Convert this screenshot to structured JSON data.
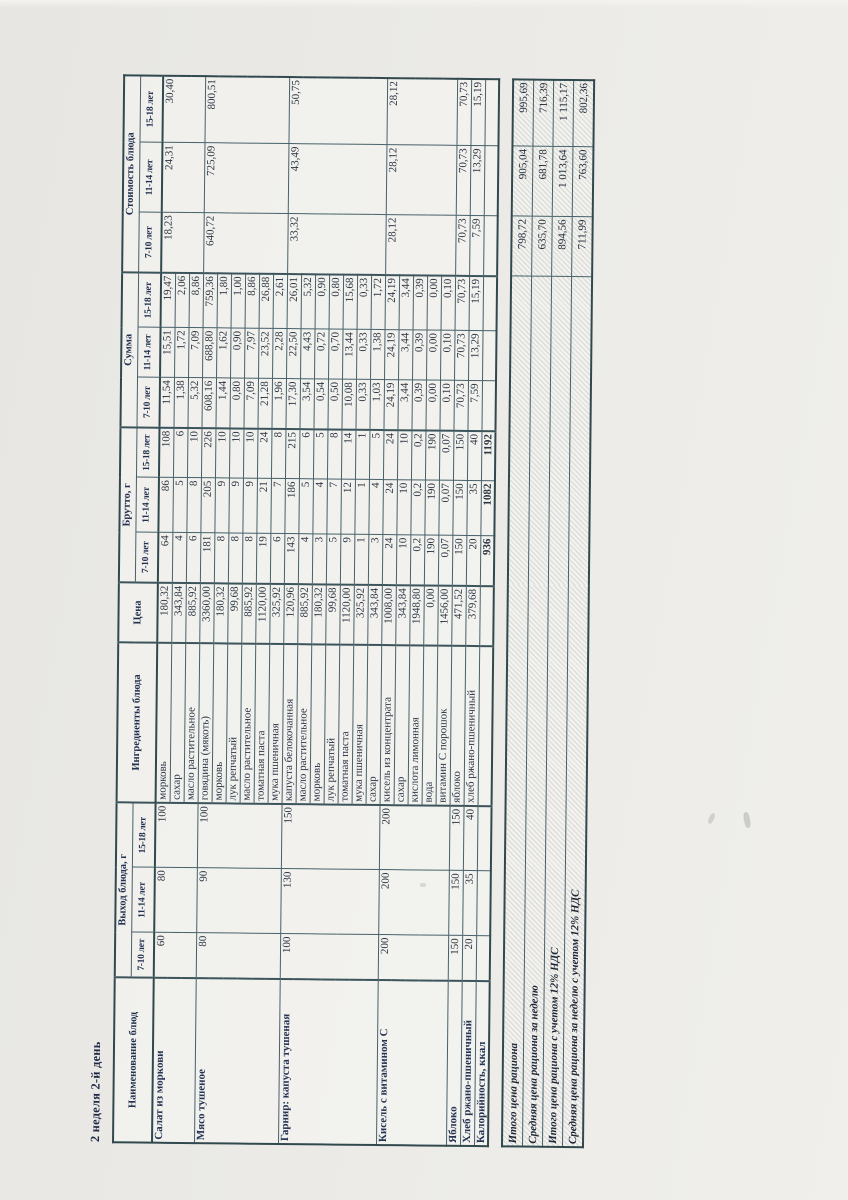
{
  "page": {
    "title": "2 неделя 2-й день"
  },
  "colors": {
    "paper": "#ebeae6",
    "ink": "#2b3442",
    "header_ink": "#21304f",
    "border": "#47616a"
  },
  "table": {
    "headers": {
      "dish": "Наименование блюд",
      "yield_group": "Выход блюда, г",
      "ingredients": "Ингредиенты блюда",
      "price": "Цена",
      "gross_group": "Брутто, г",
      "sum_group": "Сумма",
      "cost_group": "Стоимость блюда",
      "age_cols": [
        "7-10 лет",
        "11-14 лет",
        "15-18 лет"
      ]
    },
    "dishes": [
      {
        "name": "Салат из моркови",
        "yield": [
          "60",
          "80",
          "100"
        ],
        "cost": [
          "18,23",
          "24,31",
          "30,40"
        ],
        "rows": [
          {
            "ingredient": "морковь",
            "price": "180,32",
            "gross": [
              "64",
              "86",
              "108"
            ],
            "sum": [
              "11,54",
              "15,51",
              "19,47"
            ]
          },
          {
            "ingredient": "сахар",
            "price": "343,84",
            "gross": [
              "4",
              "5",
              "6"
            ],
            "sum": [
              "1,38",
              "1,72",
              "2,06"
            ]
          },
          {
            "ingredient": "масло растительное",
            "price": "885,92",
            "gross": [
              "6",
              "8",
              "10"
            ],
            "sum": [
              "5,32",
              "7,09",
              "8,86"
            ]
          }
        ]
      },
      {
        "name": "Мясо тушеное",
        "yield": [
          "80",
          "90",
          "100"
        ],
        "cost": [
          "640,72",
          "725,09",
          "800,51"
        ],
        "rows": [
          {
            "ingredient": "говядина (мякоть)",
            "price": "3360,00",
            "gross": [
              "181",
              "205",
              "226"
            ],
            "sum": [
              "608,16",
              "688,80",
              "759,36"
            ]
          },
          {
            "ingredient": "морковь",
            "price": "180,32",
            "gross": [
              "8",
              "9",
              "10"
            ],
            "sum": [
              "1,44",
              "1,62",
              "1,80"
            ]
          },
          {
            "ingredient": "лук репчатый",
            "price": "99,68",
            "gross": [
              "8",
              "9",
              "10"
            ],
            "sum": [
              "0,80",
              "0,90",
              "1,00"
            ]
          },
          {
            "ingredient": "масло растительное",
            "price": "885,92",
            "gross": [
              "8",
              "9",
              "10"
            ],
            "sum": [
              "7,09",
              "7,97",
              "8,86"
            ]
          },
          {
            "ingredient": "томатная паста",
            "price": "1120,00",
            "gross": [
              "19",
              "21",
              "24"
            ],
            "sum": [
              "21,28",
              "23,52",
              "26,88"
            ]
          },
          {
            "ingredient": "мука пшеничная",
            "price": "325,92",
            "gross": [
              "6",
              "7",
              "8"
            ],
            "sum": [
              "1,96",
              "2,28",
              "2,61"
            ]
          }
        ]
      },
      {
        "name": "Гарнир: капуста тушеная",
        "yield": [
          "100",
          "130",
          "150"
        ],
        "cost": [
          "33,32",
          "43,49",
          "50,75"
        ],
        "rows": [
          {
            "ingredient": "капуста белокочанная",
            "price": "120,96",
            "gross": [
              "143",
              "186",
              "215"
            ],
            "sum": [
              "17,30",
              "22,50",
              "26,01"
            ]
          },
          {
            "ingredient": "масло растительное",
            "price": "885,92",
            "gross": [
              "4",
              "5",
              "6"
            ],
            "sum": [
              "3,54",
              "4,43",
              "5,32"
            ]
          },
          {
            "ingredient": "морковь",
            "price": "180,32",
            "gross": [
              "3",
              "4",
              "5"
            ],
            "sum": [
              "0,54",
              "0,72",
              "0,90"
            ]
          },
          {
            "ingredient": "лук репчатый",
            "price": "99,68",
            "gross": [
              "5",
              "7",
              "8"
            ],
            "sum": [
              "0,50",
              "0,70",
              "0,80"
            ]
          },
          {
            "ingredient": "томатная паста",
            "price": "1120,00",
            "gross": [
              "9",
              "12",
              "14"
            ],
            "sum": [
              "10,08",
              "13,44",
              "15,68"
            ]
          },
          {
            "ingredient": "мука пшеничная",
            "price": "325,92",
            "gross": [
              "1",
              "1",
              "1"
            ],
            "sum": [
              "0,33",
              "0,33",
              "0,33"
            ]
          },
          {
            "ingredient": "сахар",
            "price": "343,84",
            "gross": [
              "3",
              "4",
              "5"
            ],
            "sum": [
              "1,03",
              "1,38",
              "1,72"
            ]
          }
        ]
      },
      {
        "name": "Кисель с витамином С",
        "yield": [
          "200",
          "200",
          "200"
        ],
        "cost": [
          "28,12",
          "28,12",
          "28,12"
        ],
        "rows": [
          {
            "ingredient": "кисель из концентрата",
            "price": "1008,00",
            "gross": [
              "24",
              "24",
              "24"
            ],
            "sum": [
              "24,19",
              "24,19",
              "24,19"
            ]
          },
          {
            "ingredient": "сахар",
            "price": "343,84",
            "gross": [
              "10",
              "10",
              "10"
            ],
            "sum": [
              "3,44",
              "3,44",
              "3,44"
            ]
          },
          {
            "ingredient": "кислота лимонная",
            "price": "1948,80",
            "gross": [
              "0,2",
              "0,2",
              "0,2"
            ],
            "sum": [
              "0,39",
              "0,39",
              "0,39"
            ]
          },
          {
            "ingredient": "вода",
            "price": "0,00",
            "gross": [
              "190",
              "190",
              "190"
            ],
            "sum": [
              "0,00",
              "0,00",
              "0,00"
            ]
          },
          {
            "ingredient": "витамин С порошок",
            "price": "1456,00",
            "gross": [
              "0,07",
              "0,07",
              "0,07"
            ],
            "sum": [
              "0,10",
              "0,10",
              "0,10"
            ]
          }
        ]
      },
      {
        "name": "Яблоко",
        "yield": [
          "150",
          "150",
          "150"
        ],
        "cost": [
          "70,73",
          "70,73",
          "70,73"
        ],
        "rows": [
          {
            "ingredient": "яблоко",
            "price": "471,52",
            "gross": [
              "150",
              "150",
              "150"
            ],
            "sum": [
              "70,73",
              "70,73",
              "70,73"
            ]
          }
        ]
      },
      {
        "name": "Хлеб ржано-пшеничный",
        "yield": [
          "20",
          "35",
          "40"
        ],
        "cost": [
          "7,59",
          "13,29",
          "15,19"
        ],
        "rows": [
          {
            "ingredient": "хлеб ржано-пшеничный",
            "price": "379,68",
            "gross": [
              "20",
              "35",
              "40"
            ],
            "sum": [
              "7,59",
              "13,29",
              "15,19"
            ]
          }
        ]
      }
    ],
    "calories_row": {
      "label": "Калорийность, ккал",
      "values": [
        "936",
        "1082",
        "1192"
      ]
    }
  },
  "summary": {
    "rows": [
      {
        "label": "Итого цена рациона",
        "values": [
          "798,72",
          "905,04",
          "995,69"
        ]
      },
      {
        "label": "Средняя цена рациона за неделю",
        "values": [
          "635,70",
          "681,78",
          "716,39"
        ]
      },
      {
        "label": "Итого цена рациона с учетом 12% НДС",
        "values": [
          "894,56",
          "1 013,64",
          "1 115,17"
        ]
      },
      {
        "label": "Средняя цена рациона за неделю с учетом 12% НДС",
        "values": [
          "711,99",
          "763,60",
          "802,36"
        ]
      }
    ]
  }
}
